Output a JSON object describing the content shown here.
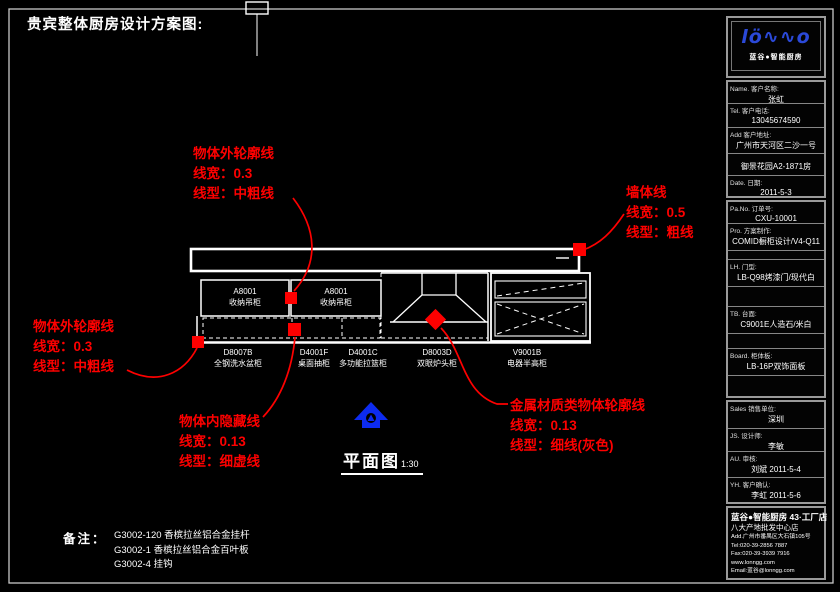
{
  "title": "贵宾整体厨房设计方案图:",
  "annotations": {
    "top": {
      "line1": "物体外轮廓线",
      "line2": "线宽：0.3",
      "line3": "线型：中粗线"
    },
    "wall": {
      "line1": "墙体线",
      "line2": "线宽：0.5",
      "line3": "线型：粗线"
    },
    "left": {
      "line1": "物体外轮廓线",
      "line2": "线宽：0.3",
      "line3": "线型：中粗线"
    },
    "hidden": {
      "line1": "物体内隐藏线",
      "line2": "线宽：0.13",
      "line3": "线型：细虚线"
    },
    "metal": {
      "line1": "金属材质类物体轮廓线",
      "line2": "线宽：0.13",
      "line3": "线型：细线(灰色)"
    }
  },
  "plan": {
    "upper_cabinets": [
      {
        "code": "A8001",
        "name": "收纳吊柜"
      },
      {
        "code": "A8001",
        "name": "收纳吊柜"
      }
    ],
    "base_labels": [
      {
        "code": "D8007B",
        "name": "全钢洗水盆柜"
      },
      {
        "code": "D4001F",
        "name": "桌面抽柜"
      },
      {
        "code": "D4001C",
        "name": "多功能拉篮柜"
      },
      {
        "code": "D8003D",
        "name": "双眼炉头柜"
      },
      {
        "code": "V9001B",
        "name": "电器半高柜"
      }
    ],
    "view": {
      "name": "平面图",
      "scale": "1:30"
    }
  },
  "notes": {
    "heading": "备注：",
    "line1": "G3002-120 香槟拉丝铝合金挂杆",
    "line2": "G3002-1 香槟拉丝铝合金百叶板",
    "line3": "G3002-4 挂钩"
  },
  "titleblock": {
    "logo": {
      "text": "lö∿∿o",
      "subtitle": "蓝谷●智能厨房"
    },
    "customer": {
      "name_label": "Name. 客户名称:",
      "name": "张虹",
      "tel_label": "Tel. 客户电话:",
      "tel": "13045674590",
      "addr_label": "Add 客户地址:",
      "addr": "广州市天河区二沙一号",
      "estate": "御景花园A2-1871房",
      "date_label": "Date. 日期:",
      "date": "2011-5-3"
    },
    "order": {
      "pano_label": "Pa.No. 订单号:",
      "pano": "CXU-10001",
      "pro_label": "Pro. 方案制作:",
      "pro": "COMID橱柜设计/V4-Q11",
      "door_label": "LH. 门型:",
      "door": "LB-Q98烤漆门/现代白",
      "top_label": "TB. 台面:",
      "top": "C9001E人造石/米白",
      "board_label": "Board. 柜体板:",
      "board": "LB-16P双饰面板"
    },
    "sign": {
      "sales_label": "Sales 销售单位:",
      "sales": "深圳",
      "designer_label": "JS. 设计师:",
      "designer": "李敏",
      "audit_label": "AU. 审核:",
      "audit": "刘斌  2011-5-4",
      "confirm_label": "YH. 客户确认:",
      "confirm": "李虹  2011-5-6"
    },
    "company": {
      "line1": "蓝谷●智能厨房 43·工厂店",
      "line2": "八大产地批发中心店",
      "line3": "Add.广州市番禺区大石镇105号",
      "line4": "Tel:020-39-2856 7887",
      "line5": "Fax:020-39-3939 7916",
      "line6": "www.lonngg.com",
      "line7": "Email:蓝谷@lonngg.com"
    }
  },
  "colors": {
    "annotation_red": "#fe0000",
    "line_white": "#ffffff",
    "logo_blue": "#2b49d8",
    "north_blue": "#0d2bf0"
  }
}
